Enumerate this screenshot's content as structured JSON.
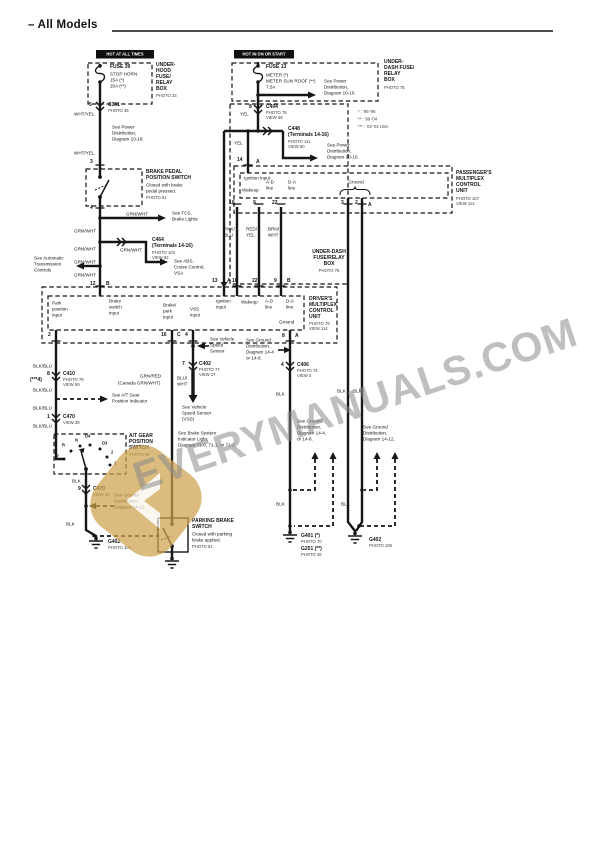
{
  "watermark": {
    "text": "EVERYMANUALS.COM",
    "text_color": "#8a8a8a",
    "logo_color": "#cfa24d"
  },
  "colors": {
    "ink": "#161616",
    "paper": "#ffffff"
  },
  "diagram": {
    "labels": [
      {
        "n": "page-title",
        "x": 28,
        "y": 21,
        "t": "– All Models",
        "c": "title"
      },
      {
        "n": "hot-at-all-times-tag",
        "x": 96,
        "y": 50,
        "t": "HOT AT ALL TIMES",
        "c": "hot",
        "w": 56
      },
      {
        "n": "hot-in-on-or-start-tag",
        "x": 234,
        "y": 50,
        "t": "HOT IN ON OR START",
        "c": "hot",
        "w": 58
      },
      {
        "n": "fuse39-name",
        "x": 110,
        "y": 64,
        "t": "FUSE 39",
        "c": "b"
      },
      {
        "n": "fuse39-detail",
        "x": 110,
        "y": 71,
        "t": "STOP HORN\n15A (*)\n20A (**)"
      },
      {
        "n": "underhood-box-label",
        "x": 156,
        "y": 62,
        "t": "UNDER-\nHOOD\nFUSE/\nRELAY\nBOX",
        "c": "b"
      },
      {
        "n": "underhood-box-photo",
        "x": 156,
        "y": 93,
        "t": "PHOTO 33",
        "c": "xs"
      },
      {
        "n": "c301-pin",
        "x": 89,
        "y": 102,
        "t": "5",
        "c": "b"
      },
      {
        "n": "c301-name",
        "x": 108,
        "y": 102,
        "t": "C301",
        "c": "b"
      },
      {
        "n": "c301-photo",
        "x": 108,
        "y": 108,
        "t": "PHOTO 35",
        "c": "xs"
      },
      {
        "n": "wire-whtyel-1",
        "x": 74,
        "y": 111,
        "t": "WHT/YEL"
      },
      {
        "n": "note-power-dist-1018",
        "x": 112,
        "y": 124,
        "t": "See Power\nDistribution,\nDiagram 10-18."
      },
      {
        "n": "wire-whtyel-2",
        "x": 74,
        "y": 150,
        "t": "WHT/YEL"
      },
      {
        "n": "pin-3",
        "x": 90,
        "y": 159,
        "t": "3",
        "c": "b"
      },
      {
        "n": "brake-pedal-switch-name",
        "x": 146,
        "y": 169,
        "t": "BRAKE PEDAL\nPOSITION SWITCH",
        "c": "b"
      },
      {
        "n": "brake-pedal-switch-desc",
        "x": 146,
        "y": 182,
        "t": "Closed with brake\npedal pressed."
      },
      {
        "n": "brake-pedal-switch-photo",
        "x": 146,
        "y": 195,
        "t": "PHOTO 81",
        "c": "xs"
      },
      {
        "n": "pin-4",
        "x": 90,
        "y": 205,
        "t": "4",
        "c": "b"
      },
      {
        "n": "wire-grnwht-tcs",
        "x": 126,
        "y": 211,
        "t": "GRN/WHT"
      },
      {
        "n": "note-tcs",
        "x": 172,
        "y": 210,
        "t": "See TCS,\nBrake Lights"
      },
      {
        "n": "wire-grnwht-2",
        "x": 74,
        "y": 228,
        "t": "GRN/WHT"
      },
      {
        "n": "c464-name",
        "x": 152,
        "y": 237,
        "t": "C464\n(Terminals 14-16)",
        "c": "b"
      },
      {
        "n": "c464-photo",
        "x": 152,
        "y": 250,
        "t": "PHOTO 103\nVIEW 82",
        "c": "xs"
      },
      {
        "n": "wire-grnwht-3",
        "x": 120,
        "y": 247,
        "t": "GRN/WHT"
      },
      {
        "n": "wire-grnwht-4",
        "x": 74,
        "y": 246,
        "t": "GRN/WHT"
      },
      {
        "n": "wire-grnwht-5",
        "x": 74,
        "y": 259,
        "t": "GRN/WHT"
      },
      {
        "n": "wire-grnwht-6",
        "x": 74,
        "y": 272,
        "t": "GRN/WHT"
      },
      {
        "n": "note-auto-trans",
        "x": 34,
        "y": 255,
        "t": "See Automatic\nTransmission\nControls"
      },
      {
        "n": "note-abs-vsa",
        "x": 174,
        "y": 258,
        "t": "See ABS,\nCruise Control,\nVSA"
      },
      {
        "n": "pin-12",
        "x": 90,
        "y": 281,
        "t": "12",
        "c": "b"
      },
      {
        "n": "pin-12-conn",
        "x": 106,
        "y": 281,
        "t": "B",
        "c": "b"
      },
      {
        "n": "fuse13-name",
        "x": 266,
        "y": 64,
        "t": "FUSE 13",
        "c": "b"
      },
      {
        "n": "fuse13-detail",
        "x": 266,
        "y": 72,
        "t": "METER (*)\nMETER SUN ROOF (**)\n7.5A"
      },
      {
        "n": "note-power-dist-1010a",
        "x": 324,
        "y": 78,
        "t": "See Power\nDistribution,\nDiagram 10-10."
      },
      {
        "n": "underdash-box-label-top",
        "x": 384,
        "y": 59,
        "t": "UNDER-\nDASH FUSE/\nRELAY\nBOX",
        "c": "b"
      },
      {
        "n": "underdash-box-photo-top",
        "x": 384,
        "y": 85,
        "t": "PHOTO 75",
        "c": "xs"
      },
      {
        "n": "legend-model-years",
        "x": 358,
        "y": 108,
        "t": "*  : '96-'98\n**  : '99-'04\n*** : '02-'04 USA",
        "c": "xs leg"
      },
      {
        "n": "c404-pin",
        "x": 249,
        "y": 104,
        "t": "8",
        "c": "b"
      },
      {
        "n": "c404-name",
        "x": 266,
        "y": 104,
        "t": "C404",
        "c": "b"
      },
      {
        "n": "c404-photo",
        "x": 266,
        "y": 110,
        "t": "PHOTO 76\nVIEW 49",
        "c": "xs"
      },
      {
        "n": "wire-yel-1",
        "x": 240,
        "y": 111,
        "t": "YEL"
      },
      {
        "n": "c448-name",
        "x": 288,
        "y": 126,
        "t": "C448\n(Terminals 14-16)",
        "c": "b"
      },
      {
        "n": "c448-photo",
        "x": 288,
        "y": 139,
        "t": "PHOTO 111\nVIEW 80",
        "c": "xs"
      },
      {
        "n": "note-power-dist-1010b",
        "x": 327,
        "y": 142,
        "t": "See Power\nDistribution,\nDiagram 10-10."
      },
      {
        "n": "wire-yel-2",
        "x": 234,
        "y": 140,
        "t": "YEL"
      },
      {
        "n": "pin-14",
        "x": 237,
        "y": 157,
        "t": "14",
        "c": "b"
      },
      {
        "n": "pin-14-conn",
        "x": 256,
        "y": 159,
        "t": "A",
        "c": "b"
      },
      {
        "n": "pass-ignition-input",
        "x": 244,
        "y": 175,
        "t": "Ignition input"
      },
      {
        "n": "pass-wakeup",
        "x": 242,
        "y": 187,
        "t": "Wakeup"
      },
      {
        "n": "pass-ad-line",
        "x": 266,
        "y": 179,
        "t": "A-D\nline"
      },
      {
        "n": "pass-da-line",
        "x": 288,
        "y": 179,
        "t": "D-A\nline"
      },
      {
        "n": "pass-ground",
        "x": 340,
        "y": 179,
        "t": "Ground",
        "w": 32,
        "c": "ctr"
      },
      {
        "n": "pass-pin-10",
        "x": 229,
        "y": 200,
        "t": "10",
        "c": "b"
      },
      {
        "n": "pass-pin-9",
        "x": 253,
        "y": 200,
        "t": "9",
        "c": "b"
      },
      {
        "n": "pass-pin-22",
        "x": 272,
        "y": 200,
        "t": "22",
        "c": "b"
      },
      {
        "n": "pass-pin-3",
        "x": 341,
        "y": 200,
        "t": "3",
        "c": "b"
      },
      {
        "n": "pass-pin-2",
        "x": 355,
        "y": 200,
        "t": "2",
        "c": "b"
      },
      {
        "n": "pass-pin-a",
        "x": 368,
        "y": 202,
        "t": "A",
        "c": "b"
      },
      {
        "n": "passenger-unit-label",
        "x": 456,
        "y": 170,
        "t": "PASSENGER'S\nMULTIPLEX\nCONTROL\nUNIT",
        "c": "b"
      },
      {
        "n": "passenger-unit-photo",
        "x": 456,
        "y": 196,
        "t": "PHOTO 107\nVIEW 112",
        "c": "xs"
      },
      {
        "n": "wire-pnkblu",
        "x": 224,
        "y": 226,
        "t": "PNK/\nBLU"
      },
      {
        "n": "wire-redyel",
        "x": 246,
        "y": 226,
        "t": "RED/\nYEL"
      },
      {
        "n": "wire-brnwht",
        "x": 268,
        "y": 226,
        "t": "BRN/\nWHT"
      },
      {
        "n": "underdash-box-label-mid",
        "x": 312,
        "y": 249,
        "t": "UNDER-DASH\nFUSE/RELAY\nBOX",
        "c": "b ctr",
        "w": 34
      },
      {
        "n": "underdash-box-photo-mid",
        "x": 312,
        "y": 268,
        "t": "PHOTO 75",
        "c": "xs ctr",
        "w": 34
      },
      {
        "n": "drv-pin-13",
        "x": 212,
        "y": 278,
        "t": "13",
        "c": "b"
      },
      {
        "n": "drv-pin-13-conn",
        "x": 227,
        "y": 278,
        "t": "A",
        "c": "b"
      },
      {
        "n": "drv-pin-10",
        "x": 232,
        "y": 278,
        "t": "10",
        "c": "b"
      },
      {
        "n": "drv-pin-22",
        "x": 252,
        "y": 278,
        "t": "22",
        "c": "b"
      },
      {
        "n": "drv-pin-9",
        "x": 274,
        "y": 278,
        "t": "9",
        "c": "b"
      },
      {
        "n": "drv-pin-9-conn",
        "x": 287,
        "y": 278,
        "t": "B",
        "c": "b"
      },
      {
        "n": "drv-park-position-input",
        "x": 52,
        "y": 300,
        "t": "Park\nposition\ninput"
      },
      {
        "n": "drv-brake-switch-input",
        "x": 109,
        "y": 298,
        "t": "Brake\nswitch\ninput"
      },
      {
        "n": "drv-brake-park-input",
        "x": 163,
        "y": 302,
        "t": "Brake/\npark\ninput"
      },
      {
        "n": "drv-vss-input",
        "x": 190,
        "y": 306,
        "t": "VSS\ninput"
      },
      {
        "n": "drv-ignition-input",
        "x": 216,
        "y": 298,
        "t": "Ignition\ninput"
      },
      {
        "n": "drv-wakeup",
        "x": 241,
        "y": 299,
        "t": "Wakeup"
      },
      {
        "n": "drv-ad-line",
        "x": 265,
        "y": 298,
        "t": "A-D\nline"
      },
      {
        "n": "drv-da-line",
        "x": 286,
        "y": 298,
        "t": "D-A\nline"
      },
      {
        "n": "drv-ground",
        "x": 279,
        "y": 319,
        "t": "Ground"
      },
      {
        "n": "driver-unit-label",
        "x": 309,
        "y": 296,
        "t": "DRIVER'S\nMULTIPLEX\nCONTROL\nUNIT",
        "c": "b"
      },
      {
        "n": "driver-unit-photo",
        "x": 309,
        "y": 321,
        "t": "PHOTO 79\nVIEW 114",
        "c": "xs"
      },
      {
        "n": "drv-pin-2",
        "x": 48,
        "y": 332,
        "t": "2",
        "c": "b"
      },
      {
        "n": "drv-pin-16",
        "x": 161,
        "y": 332,
        "t": "16",
        "c": "b"
      },
      {
        "n": "drv-pin-16-conn",
        "x": 177,
        "y": 332,
        "t": "C",
        "c": "b"
      },
      {
        "n": "drv-pin-4",
        "x": 185,
        "y": 332,
        "t": "4",
        "c": "b"
      },
      {
        "n": "drv-pin-8",
        "x": 282,
        "y": 333,
        "t": "8",
        "c": "b"
      },
      {
        "n": "drv-pin-8-conn",
        "x": 295,
        "y": 333,
        "t": "A",
        "c": "b"
      },
      {
        "n": "note-vss-upper",
        "x": 210,
        "y": 336,
        "t": "See Vehicle\nSpeed\nSensor"
      },
      {
        "n": "note-ground-dist-drv",
        "x": 246,
        "y": 337,
        "t": "See Ground\nDistribution,\nDiagram 14-4\nor 14-8."
      },
      {
        "n": "c406-pin",
        "x": 281,
        "y": 362,
        "t": "4",
        "c": "b"
      },
      {
        "n": "c406-name",
        "x": 297,
        "y": 362,
        "t": "C406",
        "c": "b"
      },
      {
        "n": "c406-photo",
        "x": 297,
        "y": 368,
        "t": "PHOTO 74\nVIEW 3",
        "c": "xs"
      },
      {
        "n": "wire-blk-1",
        "x": 276,
        "y": 391,
        "t": "BLK"
      },
      {
        "n": "c402-pin",
        "x": 182,
        "y": 361,
        "t": "7",
        "c": "b"
      },
      {
        "n": "c402-name",
        "x": 199,
        "y": 361,
        "t": "C402",
        "c": "b"
      },
      {
        "n": "c402-photo",
        "x": 199,
        "y": 367,
        "t": "PHOTO 77\nVIEW 27",
        "c": "xs"
      },
      {
        "n": "wire-bluwht",
        "x": 177,
        "y": 375,
        "t": "BLU/\nWHT"
      },
      {
        "n": "note-vss-lower",
        "x": 182,
        "y": 404,
        "t": "See Vehicle\nSpeed Sensor\n(VSS)"
      },
      {
        "n": "note-brake-indicator",
        "x": 178,
        "y": 430,
        "t": "See Brake System\nIndicator Light,\nDiagram 71-0, 71-1, or 71-2."
      },
      {
        "n": "wire-blkblu-1",
        "x": 33,
        "y": 363,
        "t": "BLK/BLU"
      },
      {
        "n": "alt-terminal-note",
        "x": 30,
        "y": 377,
        "t": "(***4)",
        "c": "b"
      },
      {
        "n": "wire-blkblu-2",
        "x": 33,
        "y": 387,
        "t": "BLK/BLU"
      },
      {
        "n": "c410-pin",
        "x": 47,
        "y": 371,
        "t": "8",
        "c": "b"
      },
      {
        "n": "c410-name",
        "x": 63,
        "y": 371,
        "t": "C410",
        "c": "b"
      },
      {
        "n": "c410-photo",
        "x": 63,
        "y": 377,
        "t": "PHOTO 79\nVIEW 59",
        "c": "xs"
      },
      {
        "n": "wire-grnred",
        "x": 140,
        "y": 373,
        "t": "GRN/RED"
      },
      {
        "n": "wire-grnred-canada",
        "x": 118,
        "y": 380,
        "t": "(Canada GRN/WHT)"
      },
      {
        "n": "note-at-indicator",
        "x": 112,
        "y": 392,
        "t": "See A/T Gear\nPosition Indicator"
      },
      {
        "n": "wire-blkblu-3",
        "x": 33,
        "y": 405,
        "t": "BLK/BLU"
      },
      {
        "n": "c470-pin",
        "x": 47,
        "y": 414,
        "t": "1",
        "c": "b"
      },
      {
        "n": "c470-name",
        "x": 63,
        "y": 414,
        "t": "C470",
        "c": "b"
      },
      {
        "n": "c470-view",
        "x": 63,
        "y": 420,
        "t": "VIEW 38",
        "c": "xs"
      },
      {
        "n": "wire-blkblu-4",
        "x": 33,
        "y": 423,
        "t": "BLK/BLU"
      },
      {
        "n": "at-gear-switch-label",
        "x": 129,
        "y": 433,
        "t": "A/T GEAR\nPOSITION\nSWITCH",
        "c": "b"
      },
      {
        "n": "at-gear-switch-photo",
        "x": 129,
        "y": 452,
        "t": "PHOTO 66",
        "c": "xs"
      },
      {
        "n": "gear-pos-p",
        "x": 56,
        "y": 454,
        "t": "P",
        "c": "pos"
      },
      {
        "n": "gear-pos-r",
        "x": 62,
        "y": 443,
        "t": "R",
        "c": "pos"
      },
      {
        "n": "gear-pos-n",
        "x": 75,
        "y": 438,
        "t": "N",
        "c": "pos"
      },
      {
        "n": "gear-pos-d4",
        "x": 85,
        "y": 434,
        "t": "D4",
        "c": "pos"
      },
      {
        "n": "gear-pos-d3",
        "x": 102,
        "y": 441,
        "t": "D3",
        "c": "pos"
      },
      {
        "n": "gear-pos-2",
        "x": 111,
        "y": 450,
        "t": "2",
        "c": "pos"
      },
      {
        "n": "gear-pos-1",
        "x": 114,
        "y": 461,
        "t": "1",
        "c": "pos"
      },
      {
        "n": "wire-blk-2",
        "x": 72,
        "y": 478,
        "t": "BLK"
      },
      {
        "n": "c470b-pin",
        "x": 78,
        "y": 486,
        "t": "9",
        "c": "b"
      },
      {
        "n": "c470b-name",
        "x": 93,
        "y": 486,
        "t": "C470",
        "c": "b"
      },
      {
        "n": "c470b-view",
        "x": 93,
        "y": 492,
        "t": "VIEW 38",
        "c": "xs"
      },
      {
        "n": "note-ground-dist-1412-left",
        "x": 114,
        "y": 492,
        "t": "See Ground\nDistribution,\nDiagram 14-12."
      },
      {
        "n": "wire-blk-3",
        "x": 66,
        "y": 521,
        "t": "BLK"
      },
      {
        "n": "g402-left-name",
        "x": 108,
        "y": 539,
        "t": "G402",
        "c": "b"
      },
      {
        "n": "g402-left-photo",
        "x": 108,
        "y": 545,
        "t": "PHOTO 108",
        "c": "xs"
      },
      {
        "n": "parking-brake-name",
        "x": 192,
        "y": 518,
        "t": "PARKING BRAKE\nSWITCH",
        "c": "b"
      },
      {
        "n": "parking-brake-desc",
        "x": 192,
        "y": 531,
        "t": "Closed with parking\nbrake applied."
      },
      {
        "n": "parking-brake-photo",
        "x": 192,
        "y": 544,
        "t": "PHOTO 81",
        "c": "xs"
      },
      {
        "n": "note-ground-dist-148-right",
        "x": 297,
        "y": 418,
        "t": "See Ground\nDistribution,\nDiagram 14-4,\nor 14-8."
      },
      {
        "n": "note-ground-dist-1412-right",
        "x": 363,
        "y": 424,
        "t": "See Ground\nDistribution,\nDiagram 14-12."
      },
      {
        "n": "wire-blk-4",
        "x": 337,
        "y": 388,
        "t": "BLK"
      },
      {
        "n": "wire-blk-5",
        "x": 353,
        "y": 388,
        "t": "BLK"
      },
      {
        "n": "wire-blk-6",
        "x": 276,
        "y": 501,
        "t": "BLK"
      },
      {
        "n": "wire-blk-7",
        "x": 341,
        "y": 501,
        "t": "BLK"
      },
      {
        "n": "g401-name",
        "x": 301,
        "y": 533,
        "t": "G401 (*)",
        "c": "b"
      },
      {
        "n": "g401-photo",
        "x": 301,
        "y": 539,
        "t": "PHOTO 70",
        "c": "xs"
      },
      {
        "n": "g251-name",
        "x": 301,
        "y": 546,
        "t": "G251 (**)",
        "c": "b"
      },
      {
        "n": "g251-photo",
        "x": 301,
        "y": 552,
        "t": "PHOTO 46",
        "c": "xs"
      },
      {
        "n": "g402-right-name",
        "x": 369,
        "y": 537,
        "t": "G402",
        "c": "b"
      },
      {
        "n": "g402-right-photo",
        "x": 369,
        "y": 543,
        "t": "PHOTO 106",
        "c": "xs"
      }
    ]
  }
}
